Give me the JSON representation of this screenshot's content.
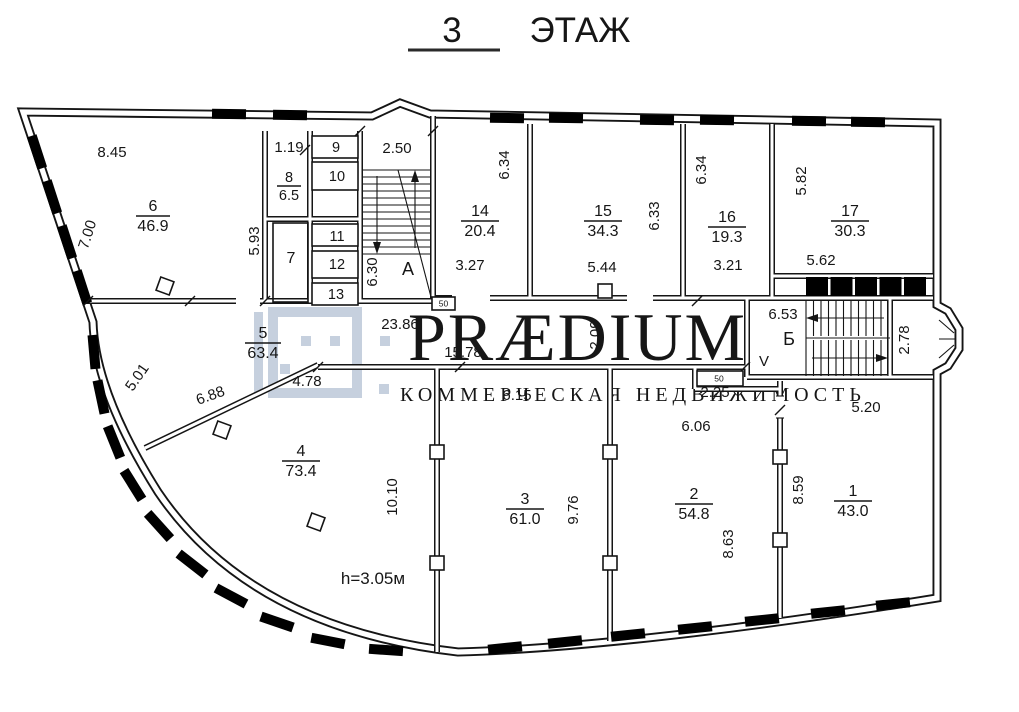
{
  "title": {
    "number": "3",
    "word": "ЭТАЖ"
  },
  "watermark": {
    "brand": "PRÆDIUM",
    "tagline": "КОММЕРЧЕСКАЯ НЕДВИЖИМОСТЬ",
    "color": "#c6d0de"
  },
  "note": {
    "height": "h=3.05м"
  },
  "colors": {
    "line": "#151515",
    "background": "#ffffff",
    "watermark": "#c6d0de"
  },
  "stairs": {
    "a": "А",
    "b": "Б",
    "v": "V"
  },
  "doors": {
    "stair_a": "50",
    "vestibule": "50"
  },
  "rooms": {
    "r1": {
      "number": "1",
      "area": "43.0"
    },
    "r2": {
      "number": "2",
      "area": "54.8"
    },
    "r3": {
      "number": "3",
      "area": "61.0"
    },
    "r4": {
      "number": "4",
      "area": "73.4"
    },
    "r5": {
      "number": "5",
      "area": "63.4"
    },
    "r6": {
      "number": "6",
      "area": "46.9"
    },
    "r7": {
      "number": "7"
    },
    "r8": {
      "number": "8",
      "area": "6.5"
    },
    "r9": {
      "number": "9"
    },
    "r10": {
      "number": "10"
    },
    "r11": {
      "number": "11"
    },
    "r12": {
      "number": "12"
    },
    "r13": {
      "number": "13"
    },
    "r14": {
      "number": "14",
      "area": "20.4"
    },
    "r15": {
      "number": "15",
      "area": "34.3"
    },
    "r16": {
      "number": "16",
      "area": "19.3"
    },
    "r17": {
      "number": "17",
      "area": "30.3"
    }
  },
  "dims": {
    "room6_top": "8.45",
    "room6_left": "7.00",
    "room8_top": "1.19",
    "room7_left": "5.93",
    "stair_a_top": "2.50",
    "stair_a_left": "6.30",
    "room14_right": "6.34",
    "room14_bottom": "3.27",
    "room15_right": "6.33",
    "room15_bottom": "5.44",
    "room16_left": "6.34",
    "room16_bottom": "3.21",
    "room17_left": "5.82",
    "room17_bottom": "5.62",
    "corridor_top": "23.86",
    "corridor_bottom": "15.78",
    "corridor_left": "5.01",
    "corridor_diag": "6.88",
    "corridor_seg": "4.78",
    "corridor_width": "2.09",
    "stair_b_top": "6.53",
    "stair_b_right": "2.78",
    "vestibule": "2.25",
    "room2_top": "6.06",
    "room2_right": "8.63",
    "room3_top": "6.15",
    "room3_right": "9.76",
    "room4_right": "10.10",
    "room1_top": "5.20",
    "room1_left": "8.59"
  }
}
